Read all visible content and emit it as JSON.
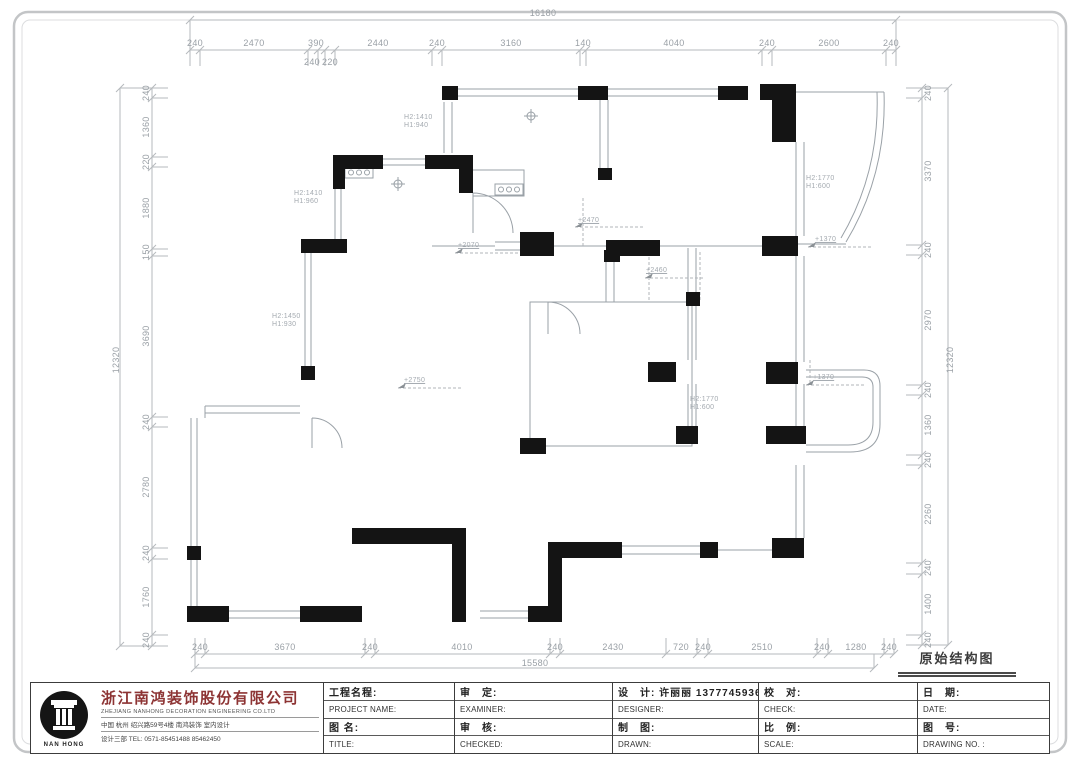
{
  "sheet": {
    "drawing_title": "原始结构图"
  },
  "company": {
    "logo_text": "NAN HONG",
    "name_cn": "浙江南鸿装饰股份有限公司",
    "name_en": "ZHEJIANG  NANHONG  DECORATION  ENGINEERING  CO.LTD",
    "address": "中国   杭州   绍兴路59号4楼   南鸿装饰   室内设计",
    "dept_tel": "设计三部        TEL:  0571-85451488   85462450"
  },
  "titleblock": {
    "col1": {
      "r1": "工程名程:",
      "r2": "PROJECT NAME:",
      "r3": "图 名:",
      "r4": "TITLE:"
    },
    "col2": {
      "r1": "审　定:",
      "r2": "EXAMINER:",
      "r3": "审　核:",
      "r4": "CHECKED:"
    },
    "col3": {
      "r1": "设　计: 许丽丽 13777459364",
      "r2": "DESIGNER:",
      "r3": "制　图:",
      "r4": "DRAWN:"
    },
    "col4": {
      "r1": "校　对:",
      "r2": "CHECK:",
      "r3": "比　例:",
      "r4": "SCALE:"
    },
    "col5": {
      "r1": "日　期:",
      "r2": "DATE:",
      "r3": "图　号:",
      "r4": "DRAWING NO. :"
    }
  },
  "colors": {
    "wall": "#141414",
    "line": "#9aa1a7",
    "dim": "#9aa0a6",
    "brand_red": "#8d3434"
  },
  "dim_labels": [
    {
      "text": "16180",
      "x": 543,
      "y": 13,
      "rot": 0
    },
    {
      "text": "240",
      "x": 195,
      "y": 43,
      "rot": 0
    },
    {
      "text": "2470",
      "x": 254,
      "y": 43,
      "rot": 0
    },
    {
      "text": "390",
      "x": 316,
      "y": 43,
      "rot": 0
    },
    {
      "text": "2440",
      "x": 378,
      "y": 43,
      "rot": 0
    },
    {
      "text": "240",
      "x": 437,
      "y": 43,
      "rot": 0
    },
    {
      "text": "3160",
      "x": 511,
      "y": 43,
      "rot": 0
    },
    {
      "text": "140",
      "x": 583,
      "y": 43,
      "rot": 0
    },
    {
      "text": "4040",
      "x": 674,
      "y": 43,
      "rot": 0
    },
    {
      "text": "240",
      "x": 767,
      "y": 43,
      "rot": 0
    },
    {
      "text": "2600",
      "x": 829,
      "y": 43,
      "rot": 0
    },
    {
      "text": "240",
      "x": 891,
      "y": 43,
      "rot": 0
    },
    {
      "text": "240",
      "x": 312,
      "y": 62,
      "rot": 0
    },
    {
      "text": "220",
      "x": 330,
      "y": 62,
      "rot": 0
    },
    {
      "text": "240",
      "x": 200,
      "y": 647,
      "rot": 0
    },
    {
      "text": "3670",
      "x": 285,
      "y": 647,
      "rot": 0
    },
    {
      "text": "240",
      "x": 370,
      "y": 647,
      "rot": 0
    },
    {
      "text": "4010",
      "x": 462,
      "y": 647,
      "rot": 0
    },
    {
      "text": "240",
      "x": 555,
      "y": 647,
      "rot": 0
    },
    {
      "text": "2430",
      "x": 613,
      "y": 647,
      "rot": 0
    },
    {
      "text": "720",
      "x": 681,
      "y": 647,
      "rot": 0
    },
    {
      "text": "240",
      "x": 703,
      "y": 647,
      "rot": 0
    },
    {
      "text": "2510",
      "x": 762,
      "y": 647,
      "rot": 0
    },
    {
      "text": "240",
      "x": 822,
      "y": 647,
      "rot": 0
    },
    {
      "text": "1280",
      "x": 856,
      "y": 647,
      "rot": 0
    },
    {
      "text": "240",
      "x": 889,
      "y": 647,
      "rot": 0
    },
    {
      "text": "15580",
      "x": 535,
      "y": 663,
      "rot": 0
    },
    {
      "text": "240",
      "x": 146,
      "y": 93,
      "rot": 1
    },
    {
      "text": "1360",
      "x": 146,
      "y": 127,
      "rot": 1
    },
    {
      "text": "220",
      "x": 146,
      "y": 162,
      "rot": 1
    },
    {
      "text": "1880",
      "x": 146,
      "y": 208,
      "rot": 1
    },
    {
      "text": "150",
      "x": 146,
      "y": 252,
      "rot": 1
    },
    {
      "text": "3690",
      "x": 146,
      "y": 336,
      "rot": 1
    },
    {
      "text": "240",
      "x": 146,
      "y": 422,
      "rot": 1
    },
    {
      "text": "2780",
      "x": 146,
      "y": 487,
      "rot": 1
    },
    {
      "text": "240",
      "x": 146,
      "y": 553,
      "rot": 1
    },
    {
      "text": "1760",
      "x": 146,
      "y": 597,
      "rot": 1
    },
    {
      "text": "240",
      "x": 146,
      "y": 640,
      "rot": 1
    },
    {
      "text": "12320",
      "x": 116,
      "y": 360,
      "rot": 1
    },
    {
      "text": "240",
      "x": 928,
      "y": 93,
      "rot": 1
    },
    {
      "text": "3370",
      "x": 928,
      "y": 171,
      "rot": 1
    },
    {
      "text": "240",
      "x": 928,
      "y": 250,
      "rot": 1
    },
    {
      "text": "2970",
      "x": 928,
      "y": 320,
      "rot": 1
    },
    {
      "text": "240",
      "x": 928,
      "y": 390,
      "rot": 1
    },
    {
      "text": "1360",
      "x": 928,
      "y": 425,
      "rot": 1
    },
    {
      "text": "240",
      "x": 928,
      "y": 460,
      "rot": 1
    },
    {
      "text": "2260",
      "x": 928,
      "y": 514,
      "rot": 1
    },
    {
      "text": "240",
      "x": 928,
      "y": 568,
      "rot": 1
    },
    {
      "text": "1400",
      "x": 928,
      "y": 604,
      "rot": 1
    },
    {
      "text": "240",
      "x": 928,
      "y": 640,
      "rot": 1
    },
    {
      "text": "12320",
      "x": 950,
      "y": 360,
      "rot": 1
    }
  ],
  "plan_labels": [
    {
      "text": "H2:1410\nH1:940",
      "x": 404,
      "y": 122
    },
    {
      "text": "H2:1410\nH1:960",
      "x": 294,
      "y": 198
    },
    {
      "text": "H2:1450\nH1:930",
      "x": 272,
      "y": 321
    },
    {
      "text": "H2:1770\nH1:600",
      "x": 806,
      "y": 183
    },
    {
      "text": "H2:1770\nH1:600",
      "x": 690,
      "y": 404
    }
  ],
  "level_labels": [
    {
      "text": "+2470",
      "x": 578,
      "y": 221
    },
    {
      "text": "+2070",
      "x": 458,
      "y": 246
    },
    {
      "text": "+2460",
      "x": 646,
      "y": 271
    },
    {
      "text": "+2750",
      "x": 404,
      "y": 381
    },
    {
      "text": "+1370",
      "x": 815,
      "y": 240
    },
    {
      "text": "+1370",
      "x": 813,
      "y": 378
    }
  ]
}
